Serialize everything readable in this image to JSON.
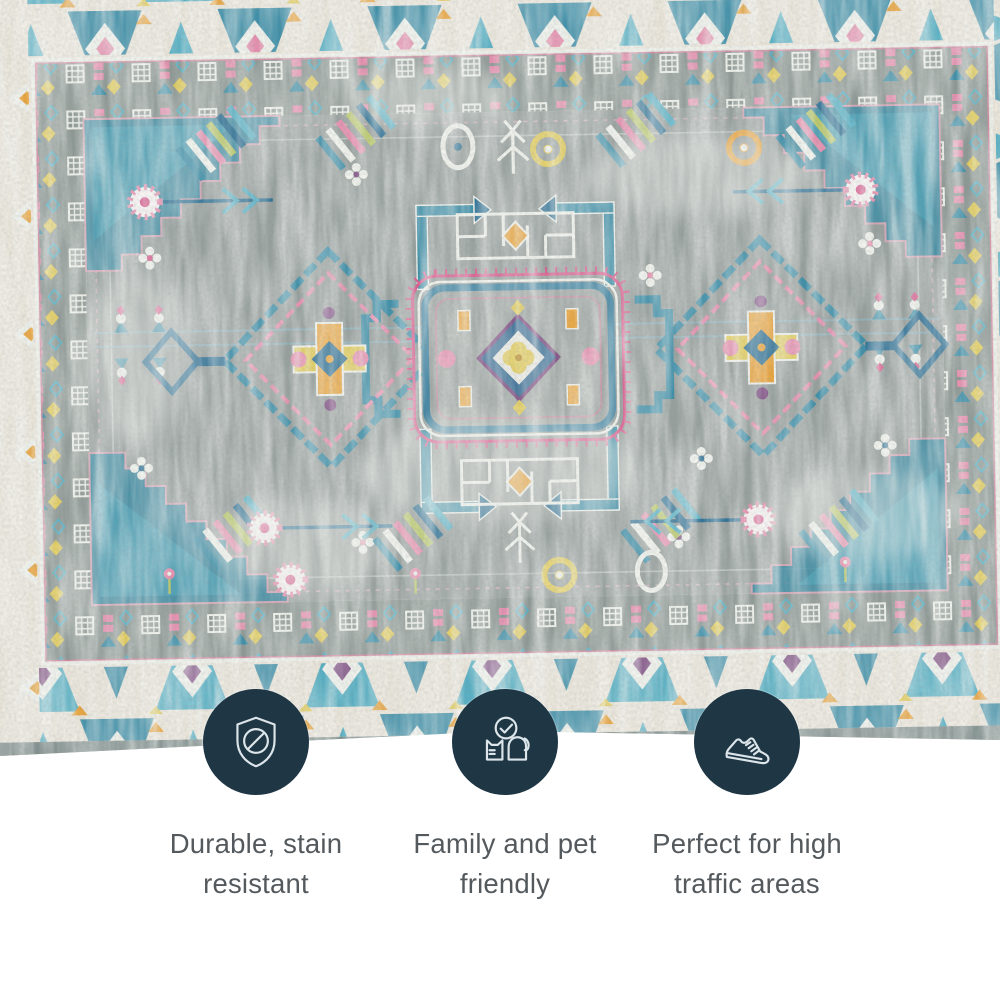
{
  "image_type": "product feature highlight image",
  "subject": "distressed vintage oriental area rug in gray, teal, blue, pink, orange and cream",
  "features": [
    {
      "icon": "shield-stain-icon",
      "label": "Durable, stain resistant"
    },
    {
      "icon": "family-pet-icon",
      "label": "Family and pet friendly"
    },
    {
      "icon": "sneaker-icon",
      "label": "Perfect for high traffic areas"
    }
  ],
  "style": {
    "badge_bg": "#1f3645",
    "icon_stroke": "#dce5e9",
    "caption_color": "#54595d",
    "page_bg": "#ffffff",
    "rug_cream": "#eae5da",
    "rug_teal": "#58b0c4",
    "rug_teal_deep": "#3f8fa8",
    "rug_blue": "#2d6f93",
    "rug_gray": "#98a09e",
    "rug_gray_band": "#8e9894",
    "rug_pink": "#e58fae",
    "rug_magenta": "#d9588c",
    "rug_purple": "#7c4a80",
    "rug_orange": "#e8a33c",
    "rug_yellow": "#e0ca58",
    "rug_green": "#b9c76a",
    "rug_white": "#eef0ea",
    "rug_selvage": "#82908e"
  }
}
